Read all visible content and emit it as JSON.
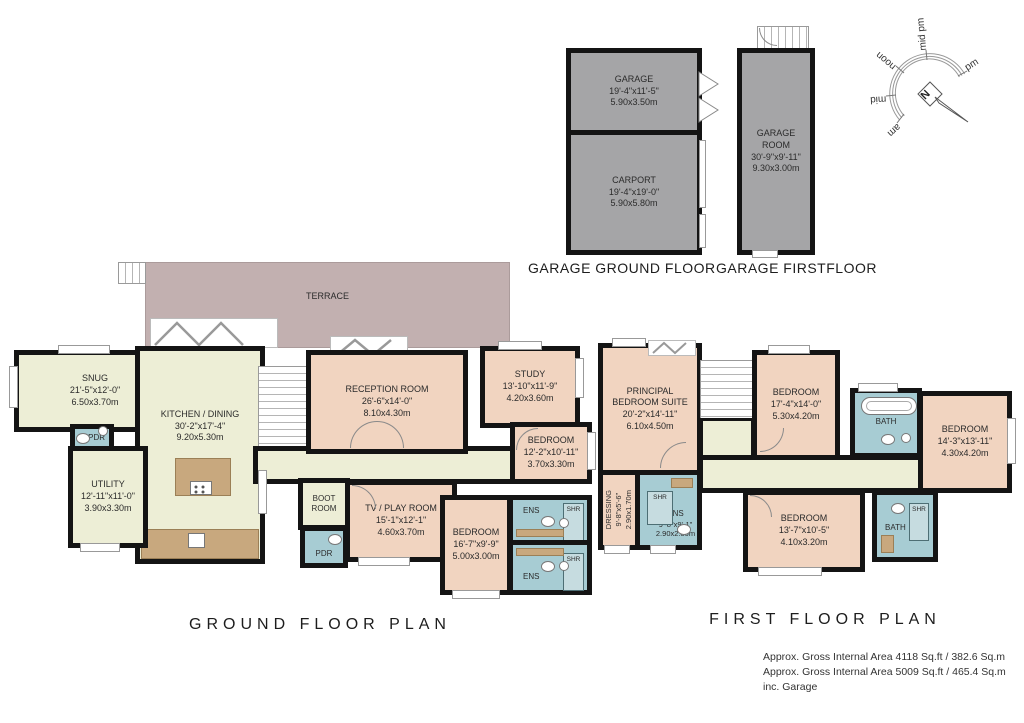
{
  "titles": {
    "garage_ground": "GARAGE GROUND FLOOR",
    "garage_first": "GARAGE FIRSTFLOOR",
    "ground_plan": "GROUND  FLOOR  PLAN",
    "first_plan": "FIRST  FLOOR  PLAN"
  },
  "footer": {
    "line1": "Approx. Gross Internal Area  4118 Sq.ft / 382.6 Sq.m",
    "line2": "Approx. Gross Internal Area  5009 Sq.ft / 465.4 Sq.m inc. Garage"
  },
  "compass": {
    "needle": "N",
    "labels": {
      "am": "am",
      "mid_am": "mid am",
      "noon": "noon",
      "mid_pm": "mid pm",
      "pm": "pm"
    }
  },
  "colors": {
    "wall": "#141414",
    "living": "#edeed6",
    "bedroom": "#f1d4c0",
    "bathroom": "#a7ccd3",
    "terrace": "#c2b0b0",
    "garage": "#a5a5a7",
    "counter": "#c8a87e"
  },
  "icons": [
    "compass-rose",
    "stairs",
    "toilet",
    "basin",
    "bathtub",
    "shower",
    "cooktop",
    "sink",
    "bifold-door",
    "door-arc",
    "garage-door"
  ],
  "rooms": {
    "garage": {
      "name": "GARAGE",
      "imperial": "19'-4\"x11'-5\"",
      "metric": "5.90x3.50m"
    },
    "carport": {
      "name": "CARPORT",
      "imperial": "19'-4\"x19'-0\"",
      "metric": "5.90x5.80m"
    },
    "garage_room": {
      "name": "GARAGE ROOM",
      "imperial": "30'-9\"x9'-11\"",
      "metric": "9.30x3.00m"
    },
    "terrace": {
      "name": "TERRACE"
    },
    "snug": {
      "name": "SNUG",
      "imperial": "21'-5\"x12'-0\"",
      "metric": "6.50x3.70m"
    },
    "kitchen": {
      "name": "KITCHEN / DINING",
      "imperial": "30'-2\"x17'-4\"",
      "metric": "9.20x5.30m"
    },
    "utility": {
      "name": "UTILITY",
      "imperial": "12'-11\"x11'-0\"",
      "metric": "3.90x3.30m"
    },
    "pdr_hall": {
      "name": "PDR"
    },
    "reception": {
      "name": "RECEPTION ROOM",
      "imperial": "26'-6\"x14'-0\"",
      "metric": "8.10x4.30m"
    },
    "study": {
      "name": "STUDY",
      "imperial": "13'-10\"x11'-9\"",
      "metric": "4.20x3.60m"
    },
    "bedroom_g1": {
      "name": "BEDROOM",
      "imperial": "12'-2\"x10'-11\"",
      "metric": "3.70x3.30m"
    },
    "boot_room": {
      "name": "BOOT ROOM"
    },
    "pdr_boot": {
      "name": "PDR"
    },
    "tv_room": {
      "name": "TV / PLAY ROOM",
      "imperial": "15'-1\"x12'-1\"",
      "metric": "4.60x3.70m"
    },
    "bedroom_g2": {
      "name": "BEDROOM",
      "imperial": "16'-7\"x9'-9\"",
      "metric": "5.00x3.00m"
    },
    "ens_g1": {
      "name": "ENS"
    },
    "shr_g1": {
      "name": "SHR"
    },
    "ens_g2": {
      "name": "ENS"
    },
    "shr_g2": {
      "name": "SHR"
    },
    "principal": {
      "name": "PRINCIPAL BEDROOM SUITE",
      "imperial": "20'-2\"x14'-11\"",
      "metric": "6.10x4.50m"
    },
    "dressing": {
      "name": "DRESSING",
      "imperial": "9'-8\"x5'-6\"",
      "metric": "2.90x1.70m"
    },
    "ens_f": {
      "name": "ENS",
      "imperial": "9'-8\"x9'-1\"",
      "metric": "2.90x2.80m"
    },
    "shr_f": {
      "name": "SHR"
    },
    "bedroom_f1": {
      "name": "BEDROOM",
      "imperial": "17'-4\"x14'-0\"",
      "metric": "5.30x4.20m"
    },
    "bath_f1": {
      "name": "BATH"
    },
    "bedroom_f2": {
      "name": "BEDROOM",
      "imperial": "14'-3\"x13'-11\"",
      "metric": "4.30x4.20m"
    },
    "bedroom_f3": {
      "name": "BEDROOM",
      "imperial": "13'-7\"x10'-5\"",
      "metric": "4.10x3.20m"
    },
    "bath_f2": {
      "name": "BATH"
    },
    "shr_f2": {
      "name": "SHR"
    }
  }
}
